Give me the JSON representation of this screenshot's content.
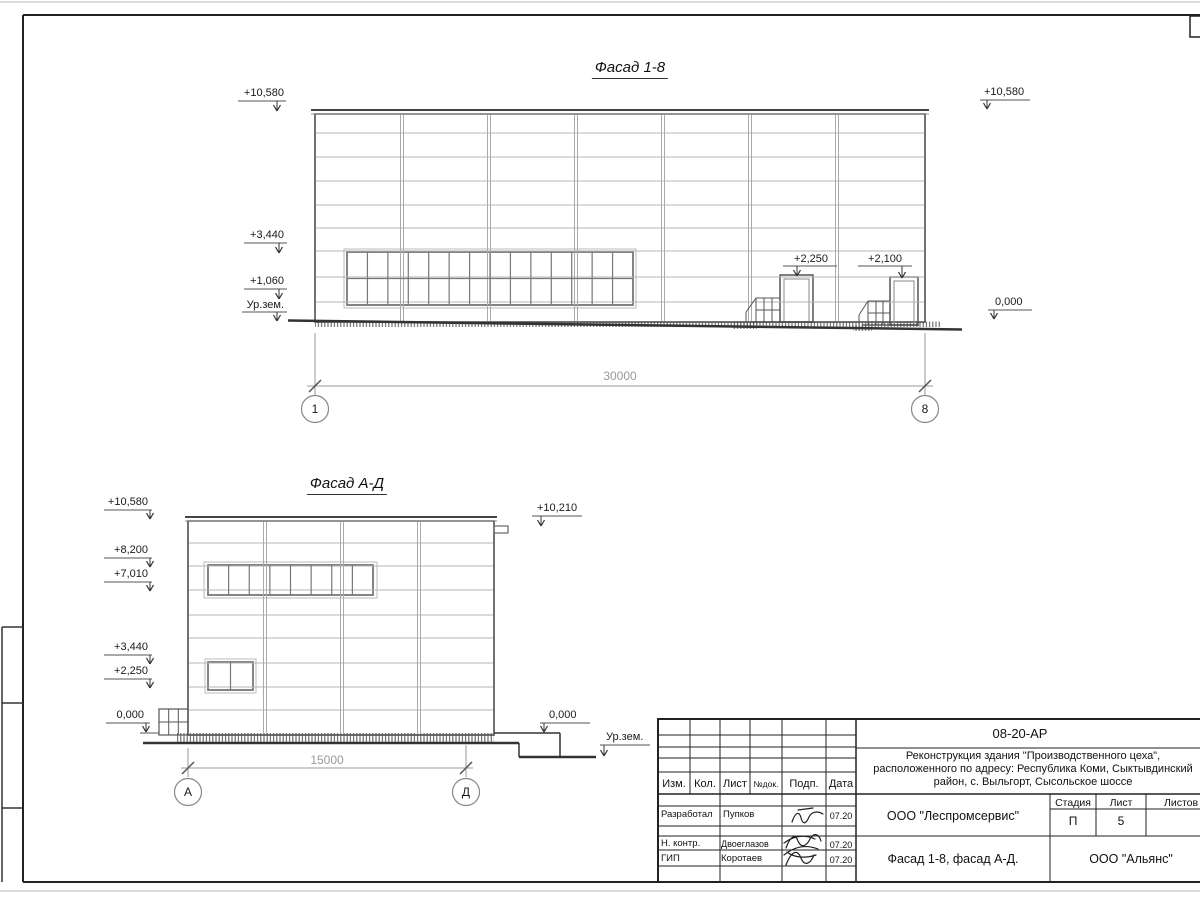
{
  "facade_1_8": {
    "title": "Фасад 1-8",
    "marks": {
      "left": [
        "+10,580",
        "+3,440",
        "+1,060",
        "Ур.зем."
      ],
      "right": [
        "+10,580",
        "0,000"
      ],
      "doors": [
        "+2,250",
        "+2,100"
      ]
    },
    "dimension": "30000",
    "axes": [
      "1",
      "8"
    ]
  },
  "facade_a_d": {
    "title": "Фасад А-Д",
    "marks": {
      "left": [
        "+10,580",
        "+8,200",
        "+7,010",
        "+3,440",
        "+2,250",
        "0,000"
      ],
      "right": [
        "+10,210",
        "0,000",
        "Ур.зем."
      ]
    },
    "dimension": "15000",
    "axes": [
      "А",
      "Д"
    ]
  },
  "title_block": {
    "code": "08-20-АР",
    "project_line1": "Реконструкция здания \"Производственного цеха\",",
    "project_line2": "расположенного по адресу: Республика Коми, Сыктывдинский",
    "project_line3": "район, с. Выльгорт, Сысольское шоссе",
    "columns": {
      "izm": "Изм.",
      "kol": "Кол.",
      "list": "Лист",
      "ndok": "№док.",
      "podp": "Подп.",
      "data": "Дата"
    },
    "rows": [
      {
        "role": "Разработал",
        "name": "Пупков",
        "date": "07.20"
      },
      {
        "role": "Н. контр.",
        "name": "Двоеглазов",
        "date": "07.20"
      },
      {
        "role": "ГИП",
        "name": "Коротаев",
        "date": "07.20"
      }
    ],
    "org_middle": "ООО \"Леспромсервис\"",
    "sheet_title": "Фасад 1-8, фасад А-Д.",
    "org_right": "ООО \"Альянс\"",
    "stage_label": "Стадия",
    "list_label": "Лист",
    "listov_label": "Листов",
    "stage_value": "П",
    "list_value": "5"
  }
}
